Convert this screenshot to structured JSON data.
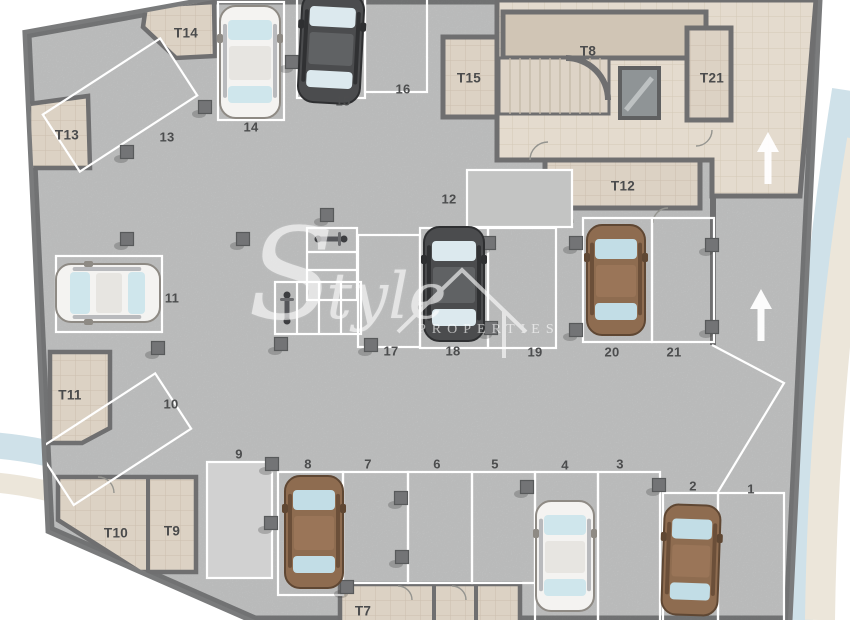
{
  "watermark": {
    "initial": "S",
    "rest": "tyle",
    "caps": "PROPERTIES"
  },
  "palette": {
    "floor": "#c8c9c9",
    "outer_wall": "#7a7b7c",
    "inner_wall": "#6f6f70",
    "room_fill": "#dcd2c4",
    "core_fill": "#e4dbce",
    "t8_fill": "#d0c5b5",
    "white_line": "#ffffff",
    "swoosh_blue": "#cfe1e9",
    "swoosh_cream": "#ece6da",
    "label_color": "#4c4d4e",
    "pillar": "#737476"
  },
  "car_colors": {
    "white": {
      "body": "#f4f3f1",
      "roof": "#e7e5e1",
      "stroke": "#8e8a84",
      "glass": "#cfe6ec",
      "side": "#b9babd"
    },
    "dark": {
      "body": "#4b4c4e",
      "roof": "#606264",
      "stroke": "#2e2f31",
      "glass": "#dce9ee",
      "side": "#303133"
    },
    "brown": {
      "body": "#8e6c50",
      "roof": "#9a7558",
      "stroke": "#5f4733",
      "glass": "#c2dde6",
      "side": "#6b4f39"
    }
  },
  "rooms": [
    {
      "id": "T14",
      "label": "T14",
      "lx": 186,
      "ly": 33
    },
    {
      "id": "T13",
      "label": "T13",
      "lx": 67,
      "ly": 135
    },
    {
      "id": "T15",
      "label": "T15",
      "lx": 469,
      "ly": 78
    },
    {
      "id": "T8",
      "label": "T8",
      "lx": 588,
      "ly": 51
    },
    {
      "id": "T21",
      "label": "T21",
      "lx": 712,
      "ly": 78
    },
    {
      "id": "T12",
      "label": "T12",
      "lx": 623,
      "ly": 186
    },
    {
      "id": "T11",
      "label": "T11",
      "lx": 70,
      "ly": 395
    },
    {
      "id": "T10",
      "label": "T10",
      "lx": 116,
      "ly": 533
    },
    {
      "id": "T9",
      "label": "T9",
      "lx": 172,
      "ly": 531
    },
    {
      "id": "T7",
      "label": "T7",
      "lx": 363,
      "ly": 611
    }
  ],
  "spots": [
    {
      "id": "1",
      "label": "1",
      "lx": 751,
      "ly": 489
    },
    {
      "id": "2",
      "label": "2",
      "lx": 693,
      "ly": 486
    },
    {
      "id": "3",
      "label": "3",
      "lx": 620,
      "ly": 464
    },
    {
      "id": "4",
      "label": "4",
      "lx": 565,
      "ly": 465
    },
    {
      "id": "5",
      "label": "5",
      "lx": 495,
      "ly": 464
    },
    {
      "id": "6",
      "label": "6",
      "lx": 437,
      "ly": 464
    },
    {
      "id": "7",
      "label": "7",
      "lx": 368,
      "ly": 464
    },
    {
      "id": "8",
      "label": "8",
      "lx": 308,
      "ly": 464
    },
    {
      "id": "9",
      "label": "9",
      "lx": 239,
      "ly": 454
    },
    {
      "id": "10",
      "label": "10",
      "lx": 171,
      "ly": 404
    },
    {
      "id": "11",
      "label": "11",
      "lx": 172,
      "ly": 298
    },
    {
      "id": "12",
      "label": "12",
      "lx": 449,
      "ly": 199
    },
    {
      "id": "13",
      "label": "13",
      "lx": 167,
      "ly": 137
    },
    {
      "id": "14",
      "label": "14",
      "lx": 251,
      "ly": 127
    },
    {
      "id": "15",
      "label": "15",
      "lx": 343,
      "ly": 101
    },
    {
      "id": "16",
      "label": "16",
      "lx": 403,
      "ly": 89
    },
    {
      "id": "17",
      "label": "17",
      "lx": 391,
      "ly": 351
    },
    {
      "id": "18",
      "label": "18",
      "lx": 453,
      "ly": 351
    },
    {
      "id": "19",
      "label": "19",
      "lx": 535,
      "ly": 352
    },
    {
      "id": "20",
      "label": "20",
      "lx": 612,
      "ly": 352
    },
    {
      "id": "21",
      "label": "21",
      "lx": 674,
      "ly": 352
    }
  ],
  "cars": [
    {
      "spot": "14",
      "color": "white",
      "cx": 250,
      "cy": 62,
      "w": 60,
      "h": 112,
      "rot": 0
    },
    {
      "spot": "15",
      "color": "dark",
      "cx": 331,
      "cy": 48,
      "w": 62,
      "h": 110,
      "rot": 3
    },
    {
      "spot": "11",
      "color": "white",
      "cx": 108,
      "cy": 293,
      "w": 58,
      "h": 104,
      "rot": -90
    },
    {
      "spot": "18",
      "color": "dark",
      "cx": 454,
      "cy": 284,
      "w": 60,
      "h": 114,
      "rot": 0
    },
    {
      "spot": "20",
      "color": "brown",
      "cx": 616,
      "cy": 280,
      "w": 58,
      "h": 110,
      "rot": 0
    },
    {
      "spot": "8",
      "color": "brown",
      "cx": 314,
      "cy": 532,
      "w": 58,
      "h": 112,
      "rot": 0
    },
    {
      "spot": "4",
      "color": "white",
      "cx": 565,
      "cy": 556,
      "w": 58,
      "h": 110,
      "rot": 0
    },
    {
      "spot": "2",
      "color": "brown",
      "cx": 691,
      "cy": 560,
      "w": 56,
      "h": 110,
      "rot": 2
    }
  ],
  "motorcycles": [
    {
      "x": 331,
      "y": 239,
      "rot": 90
    },
    {
      "x": 287,
      "y": 308,
      "rot": 0
    }
  ],
  "arrows": [
    {
      "dir": "up",
      "x": 768,
      "y": 158
    },
    {
      "dir": "up",
      "x": 761,
      "y": 315
    }
  ],
  "pillars": [
    [
      205,
      107
    ],
    [
      127,
      152
    ],
    [
      292,
      62
    ],
    [
      327,
      215
    ],
    [
      243,
      239
    ],
    [
      127,
      239
    ],
    [
      158,
      348
    ],
    [
      281,
      344
    ],
    [
      371,
      345
    ],
    [
      489,
      243
    ],
    [
      491,
      328
    ],
    [
      576,
      243
    ],
    [
      576,
      330
    ],
    [
      712,
      245
    ],
    [
      712,
      327
    ],
    [
      272,
      464
    ],
    [
      271,
      523
    ],
    [
      401,
      498
    ],
    [
      402,
      557
    ],
    [
      347,
      587
    ],
    [
      527,
      487
    ],
    [
      659,
      485
    ]
  ]
}
